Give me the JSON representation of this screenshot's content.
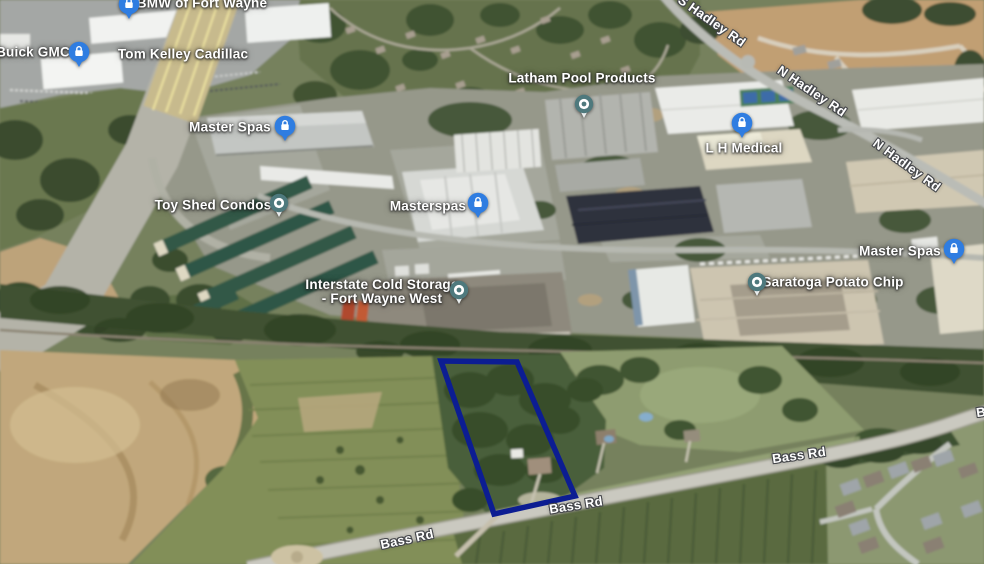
{
  "map": {
    "business_labels": [
      {
        "name": "bmw-of-fort-wayne",
        "text": "BMW of Fort Wayne",
        "pin": "lock"
      },
      {
        "name": "buick-gmc",
        "text": "Buick GMC",
        "pin": "lock"
      },
      {
        "name": "tom-kelley-cadillac",
        "text": "Tom Kelley Cadillac",
        "pin": null
      },
      {
        "name": "master-spas-north",
        "text": "Master Spas",
        "pin": "lock"
      },
      {
        "name": "latham-pool-products",
        "text": "Latham Pool Products",
        "pin": "dot"
      },
      {
        "name": "l-h-medical",
        "text": "L H Medical",
        "pin": "lock"
      },
      {
        "name": "toy-shed-condos",
        "text": "Toy Shed Condos",
        "pin": "dot"
      },
      {
        "name": "masterspas",
        "text": "Masterspas",
        "pin": "lock"
      },
      {
        "name": "interstate-cold-storage",
        "text": "Interstate Cold Storage",
        "text2": "- Fort Wayne West",
        "pin": "dot"
      },
      {
        "name": "master-spas-east",
        "text": "Master Spas",
        "pin": "lock"
      },
      {
        "name": "saratoga-potato-chip",
        "text": "Saratoga Potato Chip",
        "pin": "dot"
      }
    ],
    "road_labels": [
      {
        "name": "s-hadley-rd",
        "text": "S Hadley Rd"
      },
      {
        "name": "n-hadley-rd-upper",
        "text": "N Hadley Rd"
      },
      {
        "name": "n-hadley-rd-lower",
        "text": "N Hadley Rd"
      },
      {
        "name": "bass-rd-center",
        "text": "Bass Rd"
      },
      {
        "name": "bass-rd-west",
        "text": "Bass Rd"
      },
      {
        "name": "bass-rd-east",
        "text": "Bass Rd"
      },
      {
        "name": "bass-rd-edge-partial",
        "text": "B"
      }
    ],
    "parcel_outline": {
      "color": "#0c1d92",
      "points": "441,361 517,362 575,496 494,514"
    },
    "pin_colors": {
      "lock_pin": "#2f7de1",
      "dot_pin": "#4e797d"
    }
  }
}
